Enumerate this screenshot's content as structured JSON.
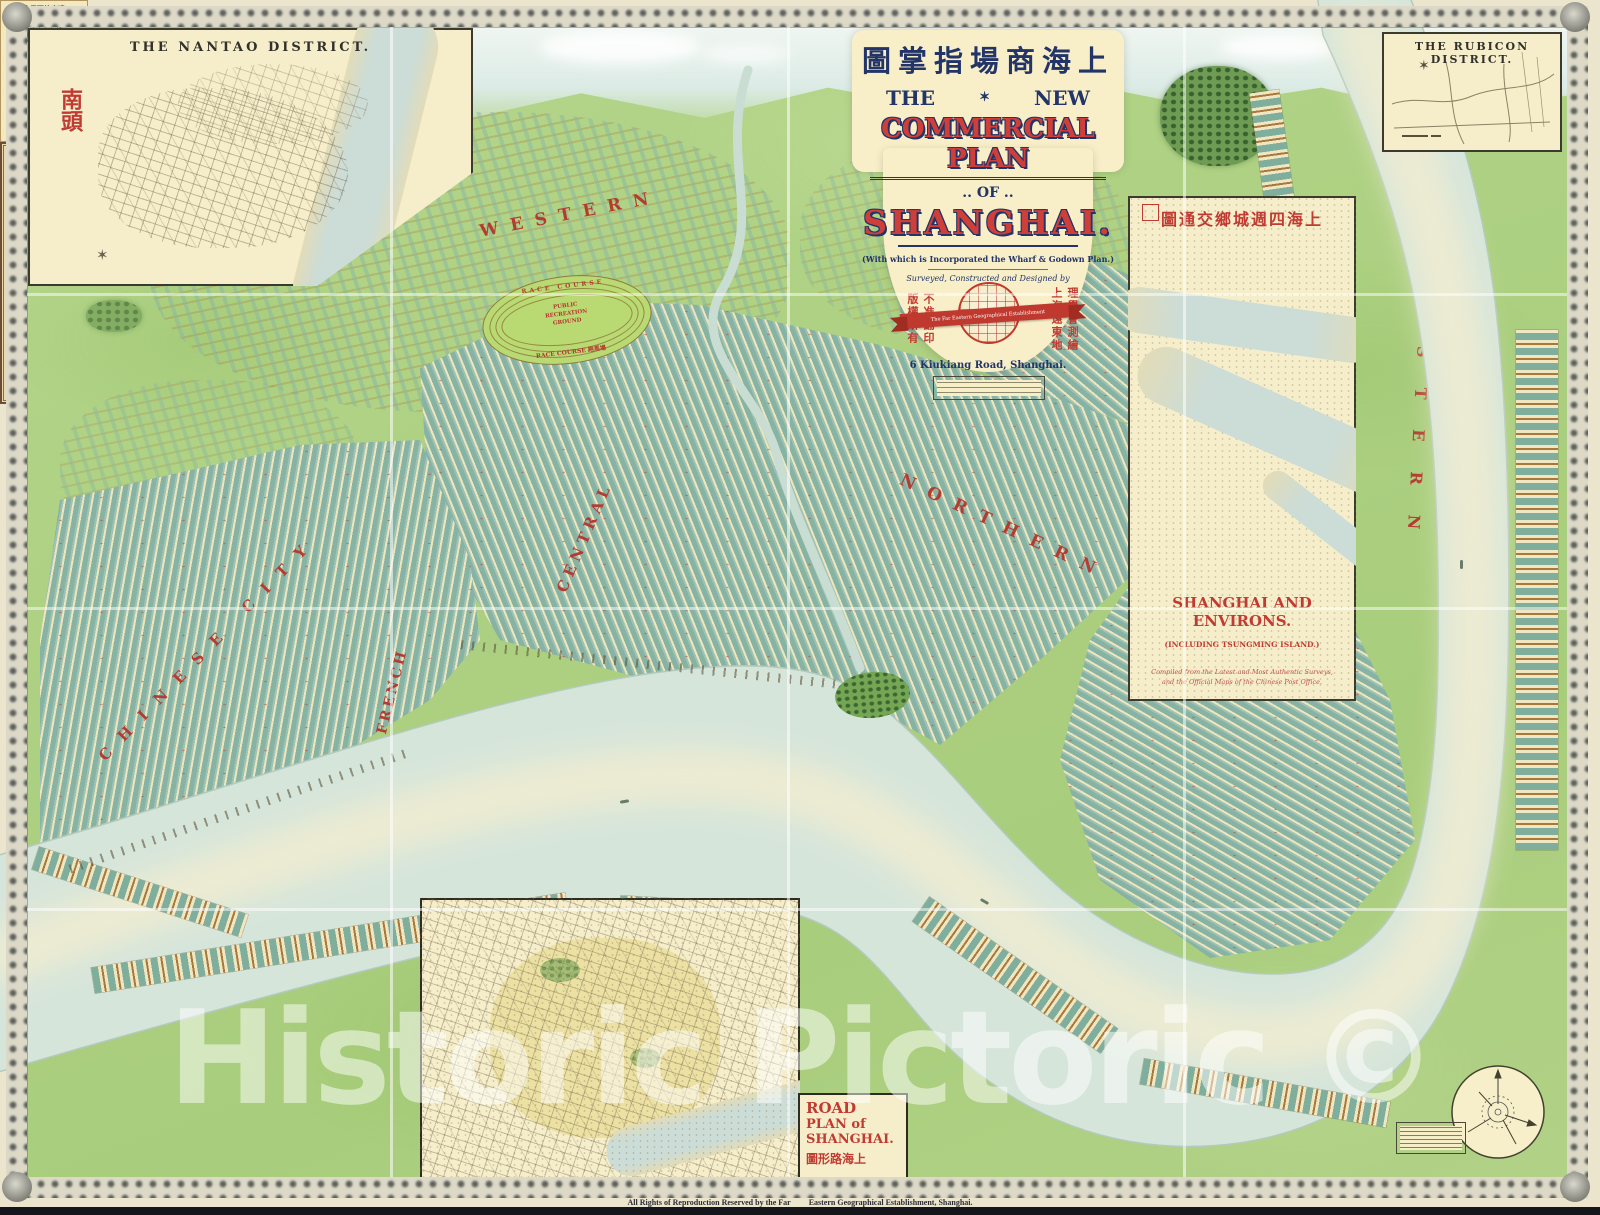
{
  "page": {
    "watermark": "Historic Pictoric ©",
    "rights_left": "All Rights of Reproduction Reserved by the Far",
    "rights_right": "Eastern Geographical Establishment, Shanghai."
  },
  "cartouche": {
    "chinese_title": "圖掌指場商海上",
    "the": "THE",
    "star": "✶",
    "new": "NEW",
    "main_line": "COMMERCIAL PLAN",
    "of_line": ".. OF ..",
    "city_line": "SHANGHAI.",
    "subtitle": "(With which is Incorporated the Wharf & Godown Plan.)",
    "byline": "Surveyed, Constructed and Designed by",
    "ribbon": "The Far Eastern Geographical Establishment",
    "address": "6 Kiukiang Road, Shanghai.",
    "seal_left_1": "版權所有",
    "seal_left_2": "不准翻印",
    "seal_right_1": "上海遠東地",
    "seal_right_2": "理學會測繪"
  },
  "insets": {
    "nantao": {
      "title": "THE NANTAO DISTRICT.",
      "seal": "南頭"
    },
    "rubicon": {
      "title": "THE RUBICON DISTRICT."
    },
    "environs": {
      "chinese_title": "圖通交鄉城週四海上",
      "title": "SHANGHAI AND ENVIRONS.",
      "subtitle": "(INCLUDING TSUNGMING ISLAND.)",
      "note_1": "Compiled from the Latest and Most Authentic Surveys,",
      "note_2": "and the Official Maps of the Chinese Post Office."
    },
    "road_plan": {
      "line1": "ROAD",
      "line2": "PLAN of",
      "line3": "SHANGHAI.",
      "chinese_title": "圖形路海上"
    }
  },
  "districts": {
    "western": "WESTERN",
    "northern": "NORTHERN",
    "central": "CENTRAL",
    "eastern": "EASTERN",
    "chinese_city": "CHINESE CITY",
    "french": "FRENCH"
  },
  "race_course": {
    "top": "RACE COURSE",
    "mid1": "PUBLIC",
    "mid2": "RECREATION",
    "mid3": "GROUND",
    "bottom": "RACE COURSE 跑馬場"
  },
  "river": {
    "whangpoo": [
      "W",
      "H",
      "A",
      "N",
      "G",
      "P",
      "O",
      "O"
    ],
    "river_word": [
      "R",
      "I",
      "V",
      "E",
      "R"
    ],
    "chinese": [
      "浦",
      "江",
      "黃",
      "浦"
    ]
  },
  "ad_box": {
    "header": "會學理地東遠",
    "lines": [
      "THE NEW MAP OF CHINA.",
      "(In English and Chinese.)",
      "The New Commercial Plan of Shanghai.",
      "The New Commercial Plan of Hongkong.",
      "The New Plan of Peking.",
      "The New Atlas and Gazetteer of China."
    ]
  },
  "colors": {
    "label_red": "#b5352c",
    "title_red": "#cf3f3a",
    "title_navy": "#223468",
    "water": "#d6e5da",
    "land": "#aed183",
    "cream": "#f6eec7"
  }
}
